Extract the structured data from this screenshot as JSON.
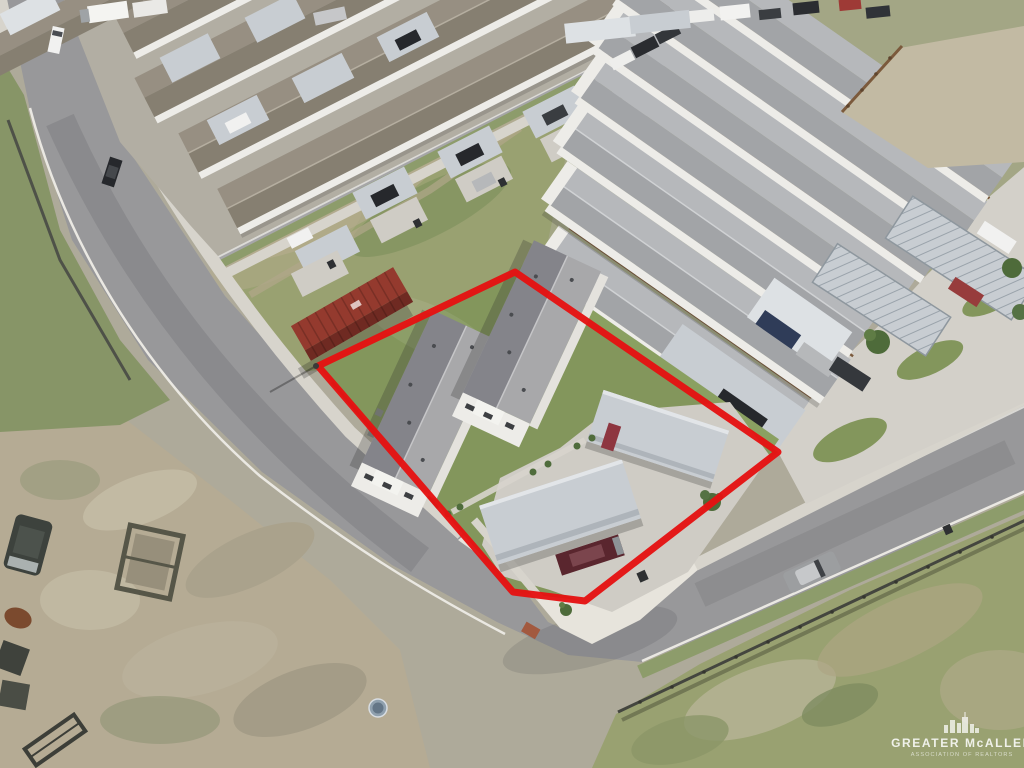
{
  "image": {
    "width": 1024,
    "height": 768,
    "kind": "aerial-drone-real-estate-photo",
    "description": "Oblique aerial photo of a new residential subdivision; a corner lot with two duplex buildings, metal carports, concrete driveway and lawn is outlined in red; surrounded by rows of identical duplexes with carports, a vacant grassy field, a rust-red shipping container, curving asphalt streets, a dirt lot with trailers and green fields."
  },
  "watermark": {
    "title": "GREATER McALLEN",
    "subtitle": "ASSOCIATION OF REALTORS",
    "icon": "city-skyline-icon"
  },
  "colors": {
    "boundary_red": "#e51212",
    "asphalt": "#98989a",
    "asphalt_light": "#a6a6a8",
    "concrete": "#d7d4cc",
    "concrete_bright": "#e7e4dc",
    "driveway": "#cfccc5",
    "curb_white": "#eae8e2",
    "roof_light": "#a8a8aa",
    "roof_dark": "#84848a",
    "roof_taupe_light": "#978f82",
    "roof_taupe_dark": "#867f71",
    "roof_cool_light": "#b6b8bb",
    "roof_cool_dark": "#a2a4a7",
    "wall_white": "#edece8",
    "wall_shade": "#d9d7d1",
    "carport": "#c8cdd2",
    "carport_light": "#dde1e4",
    "carport_rib": "#9aa3ab",
    "grass_field": "#99a171",
    "grass_lawn": "#83965c",
    "grass_strip": "#8d9c6b",
    "grass_dry": "#b3ab8c",
    "dirt": "#b5ab94",
    "dirt_light": "#c2baa3",
    "fence_brown": "#7b5a3c",
    "drain_dark": "#4e5148",
    "container_top": "#943a2e",
    "container_side": "#6f2a22",
    "van_maroon": "#5a262e",
    "car_black": "#26282c",
    "car_white": "#f1f1f0",
    "car_silver": "#b6b8ba",
    "car_red": "#8e3640",
    "car_blue": "#2f3c58",
    "tree_green": "#4e6b3a",
    "manhole_blue": "#8fa0ae",
    "ada_ramp": "#a2593f"
  },
  "scene": {
    "subject_property": {
      "label": "red-outlined corner lot",
      "features": [
        "duplex building 1",
        "duplex building 2",
        "metal carport A",
        "metal carport B",
        "maroon van",
        "red compact car",
        "concrete driveway",
        "lawn",
        "small trees",
        "back fence"
      ]
    },
    "surroundings": {
      "left_block": "rows of duplexes with taupe roofs and attached carports facing the upper street",
      "right_block": "rows of duplexes with light gray roofs, brown backyard fences and carports along the curving street",
      "vacant_field": "patchy green field behind the subject lot",
      "shipping_container": "rust-red storage container beside the boundary",
      "streets": [
        "curving corner street wrapping the lot",
        "diagonal upper street",
        "street along the top edge"
      ],
      "bottom_left": "dirt lot with dark van, utility trailers and equipment",
      "bottom_right": "green field behind a dark fence line",
      "parked_vehicles": [
        "silver car on right street",
        "black car on left street",
        "white pickup on left street",
        "trucks along the top edge"
      ],
      "street_objects": [
        "blue water-meter/manhole cover",
        "trash bins",
        "ADA corner ramp",
        "utility pole"
      ]
    }
  }
}
